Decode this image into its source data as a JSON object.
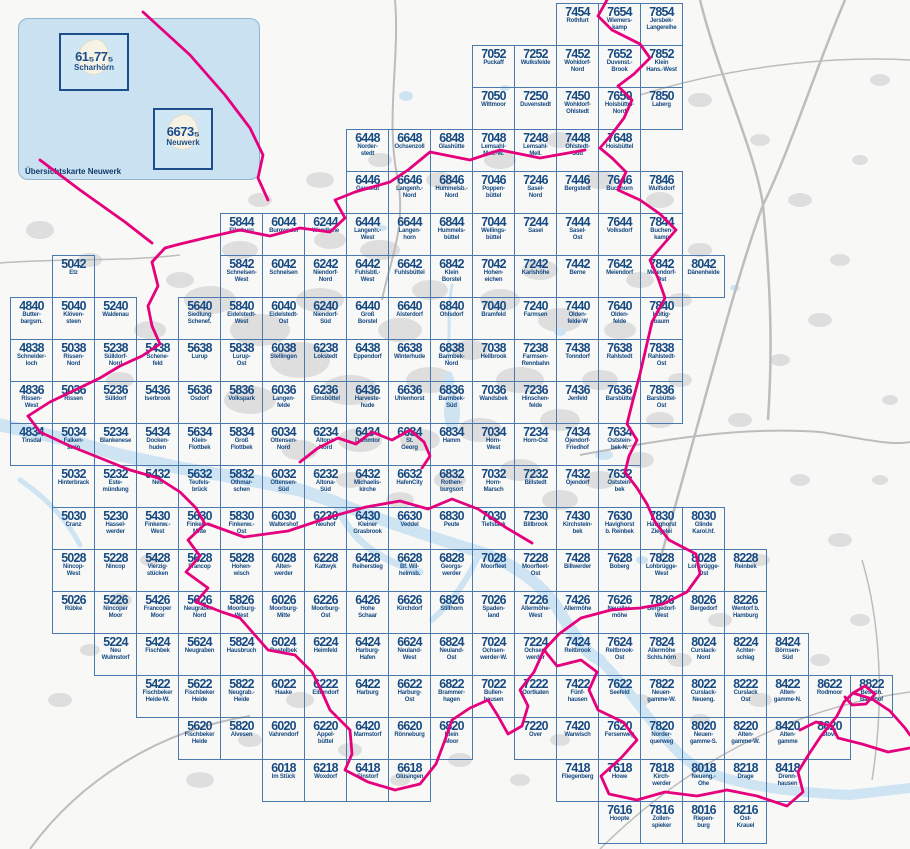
{
  "colors": {
    "accent_magenta": "#e5007d",
    "grid_blue": "#4a79ad",
    "label_blue": "#174a82",
    "water_blue": "#cfe4f2",
    "inset_blue": "#c9e1f1",
    "land_gray": "#dedede"
  },
  "inset": {
    "caption": "Übersichtskarte Neuwerk",
    "islands": [
      {
        "number": "61₅77₅",
        "name": "Scharhörn"
      },
      {
        "number": "6673₅",
        "name": "Neuwerk"
      }
    ]
  },
  "tiles": [
    {
      "id": "7454",
      "name": "Rothfurt"
    },
    {
      "id": "7654",
      "name": "Wiemers-\nkamp"
    },
    {
      "id": "7854",
      "name": "Jersbek-\nLangereihe"
    },
    {
      "id": "7052",
      "name": "Puckaff"
    },
    {
      "id": "7252",
      "name": "Wulksfelde"
    },
    {
      "id": "7452",
      "name": "Wohldorf-\nNord"
    },
    {
      "id": "7652",
      "name": "Duvenst.-\nBrook"
    },
    {
      "id": "7852",
      "name": "Klein\nHans.-West"
    },
    {
      "id": "7050",
      "name": "Wittmoor"
    },
    {
      "id": "7250",
      "name": "Duvenstedt"
    },
    {
      "id": "7450",
      "name": "Wohldorf-\nOhlstedt"
    },
    {
      "id": "7650",
      "name": "Hoisbüttel-\nNord"
    },
    {
      "id": "7850",
      "name": "Laberg"
    },
    {
      "id": "6448",
      "name": "Norder-\nstedt"
    },
    {
      "id": "6648",
      "name": "Ochsenzoll"
    },
    {
      "id": "6848",
      "name": "Glashütte"
    },
    {
      "id": "7048",
      "name": "Lemsahl-\nMell.-W."
    },
    {
      "id": "7248",
      "name": "Lemsahl-\nMell."
    },
    {
      "id": "7448",
      "name": "Ohlstedt-\nSüd"
    },
    {
      "id": "7648",
      "name": "Hoisbüttel"
    },
    {
      "id": "6446",
      "name": "Garstedt"
    },
    {
      "id": "6646",
      "name": "Langenh.-\nNord"
    },
    {
      "id": "6846",
      "name": "Hummelsb.-\nNord"
    },
    {
      "id": "7046",
      "name": "Poppen-\nbüttel"
    },
    {
      "id": "7246",
      "name": "Sasel-\nNord"
    },
    {
      "id": "7446",
      "name": "Bergstedt"
    },
    {
      "id": "7646",
      "name": "Buckhorn"
    },
    {
      "id": "7846",
      "name": "Wulfsdorf"
    },
    {
      "id": "5844",
      "name": "Ellerburg"
    },
    {
      "id": "6044",
      "name": "Burgwedel"
    },
    {
      "id": "6244",
      "name": "Wendlohe"
    },
    {
      "id": "6444",
      "name": "Langenh.-\nWest"
    },
    {
      "id": "6644",
      "name": "Langen-\nhorn"
    },
    {
      "id": "6844",
      "name": "Hummels-\nbüttel"
    },
    {
      "id": "7044",
      "name": "Wellings-\nbüttel"
    },
    {
      "id": "7244",
      "name": "Sasel"
    },
    {
      "id": "7444",
      "name": "Sasel-\nOst"
    },
    {
      "id": "7644",
      "name": "Volksdorf"
    },
    {
      "id": "7844",
      "name": "Buchen-\nkamp"
    },
    {
      "id": "5042",
      "name": "Etz"
    },
    {
      "id": "5842",
      "name": "Schnelsen-\nWest"
    },
    {
      "id": "6042",
      "name": "Schnelsen"
    },
    {
      "id": "6242",
      "name": "Niendorf-\nNord"
    },
    {
      "id": "6442",
      "name": "Fuhlsbtl.-\nWest"
    },
    {
      "id": "6642",
      "name": "Fuhlsbüttel"
    },
    {
      "id": "6842",
      "name": "Klein\nBorstel"
    },
    {
      "id": "7042",
      "name": "Hohen-\neichen"
    },
    {
      "id": "7242",
      "name": "Karlshöhe"
    },
    {
      "id": "7442",
      "name": "Berne"
    },
    {
      "id": "7642",
      "name": "Meiendorf"
    },
    {
      "id": "7842",
      "name": "Meiendorf-\nOst"
    },
    {
      "id": "8042",
      "name": "Dänenheide"
    },
    {
      "id": "4840",
      "name": "Butter-\nbargsm."
    },
    {
      "id": "5040",
      "name": "Klöven-\nsteen"
    },
    {
      "id": "5240",
      "name": "Waldenau"
    },
    {
      "id": "5640",
      "name": "Siedlung\nSchenef."
    },
    {
      "id": "5840",
      "name": "Eidelstedt-\nWest"
    },
    {
      "id": "6040",
      "name": "Eidelstedt-\nOst"
    },
    {
      "id": "6240",
      "name": "Niendorf-\nSüd"
    },
    {
      "id": "6440",
      "name": "Groß\nBorstel"
    },
    {
      "id": "6640",
      "name": "Alsterdorf"
    },
    {
      "id": "6840",
      "name": "Ohlsdorf"
    },
    {
      "id": "7040",
      "name": "Bramfeld"
    },
    {
      "id": "7240",
      "name": "Farmsen"
    },
    {
      "id": "7440",
      "name": "Olden-\nfelde-W"
    },
    {
      "id": "7640",
      "name": "Olden-\nfelde"
    },
    {
      "id": "7840",
      "name": "Höltig-\nbaum"
    },
    {
      "id": "4838",
      "name": "Schneider-\nloch"
    },
    {
      "id": "5038",
      "name": "Rissen-\nNord"
    },
    {
      "id": "5238",
      "name": "Sülldorf-\nNord"
    },
    {
      "id": "5438",
      "name": "Schene-\nfeld"
    },
    {
      "id": "5638",
      "name": "Lurup"
    },
    {
      "id": "5838",
      "name": "Lurup-\nOst"
    },
    {
      "id": "6038",
      "name": "Stellingen"
    },
    {
      "id": "6238",
      "name": "Lokstedt"
    },
    {
      "id": "6438",
      "name": "Eppendorf"
    },
    {
      "id": "6638",
      "name": "Winterhude"
    },
    {
      "id": "6838",
      "name": "Barmbek-\nNord"
    },
    {
      "id": "7038",
      "name": "Hellbrook"
    },
    {
      "id": "7238",
      "name": "Farmsen-\nRennbahn"
    },
    {
      "id": "7438",
      "name": "Tonndorf"
    },
    {
      "id": "7638",
      "name": "Rahlstedt"
    },
    {
      "id": "7838",
      "name": "Rahlstedt-\nOst"
    },
    {
      "id": "4836",
      "name": "Rissen-\nWest"
    },
    {
      "id": "5036",
      "name": "Rissen"
    },
    {
      "id": "5236",
      "name": "Sülldorf"
    },
    {
      "id": "5436",
      "name": "Iserbrook"
    },
    {
      "id": "5636",
      "name": "Osdorf"
    },
    {
      "id": "5836",
      "name": "Volkspark"
    },
    {
      "id": "6036",
      "name": "Langen-\nfelde"
    },
    {
      "id": "6236",
      "name": "Eimsbüttel"
    },
    {
      "id": "6436",
      "name": "Harveste-\nhude"
    },
    {
      "id": "6636",
      "name": "Uhlenhorst"
    },
    {
      "id": "6836",
      "name": "Barmbek-\nSüd"
    },
    {
      "id": "7036",
      "name": "Wandsbek"
    },
    {
      "id": "7236",
      "name": "Hinschen-\nfelde"
    },
    {
      "id": "7436",
      "name": "Jenfeld"
    },
    {
      "id": "7636",
      "name": "Barsbüttel"
    },
    {
      "id": "7836",
      "name": "Barsbüttel-\nOst"
    },
    {
      "id": "4834",
      "name": "Tinsdal"
    },
    {
      "id": "5034",
      "name": "Falken-\nstein"
    },
    {
      "id": "5234",
      "name": "Blankenese"
    },
    {
      "id": "5434",
      "name": "Docken-\nhuden"
    },
    {
      "id": "5634",
      "name": "Klein-\nFlottbek"
    },
    {
      "id": "5834",
      "name": "Groß\nFlottbek"
    },
    {
      "id": "6034",
      "name": "Ottensen-\nNord"
    },
    {
      "id": "6234",
      "name": "Altona-\nNord"
    },
    {
      "id": "6434",
      "name": "Dammtor"
    },
    {
      "id": "6634",
      "name": "St.\nGeorg"
    },
    {
      "id": "6834",
      "name": "Hamm"
    },
    {
      "id": "7034",
      "name": "Horn-\nWest"
    },
    {
      "id": "7234",
      "name": "Horn-Ost"
    },
    {
      "id": "7434",
      "name": "Öjendorf-\nFriedhof"
    },
    {
      "id": "7634",
      "name": "Oststein-\nbek-N."
    },
    {
      "id": "5032",
      "name": "Hinterbrack"
    },
    {
      "id": "5232",
      "name": "Este-\nmündung"
    },
    {
      "id": "5432",
      "name": "Neß"
    },
    {
      "id": "5632",
      "name": "Teufels-\nbrück"
    },
    {
      "id": "5832",
      "name": "Othmar-\nschen"
    },
    {
      "id": "6032",
      "name": "Ottensen-\nSüd"
    },
    {
      "id": "6232",
      "name": "Altona-\nSüd"
    },
    {
      "id": "6432",
      "name": "Michaelis-\nkirche"
    },
    {
      "id": "6632",
      "name": "HafenCity"
    },
    {
      "id": "6832",
      "name": "Rothen-\nburgsort"
    },
    {
      "id": "7032",
      "name": "Horn-\nMarsch"
    },
    {
      "id": "7232",
      "name": "Billstedt"
    },
    {
      "id": "7432",
      "name": "Öjendorf"
    },
    {
      "id": "7632",
      "name": "Oststein-\nbek"
    },
    {
      "id": "5030",
      "name": "Cranz"
    },
    {
      "id": "5230",
      "name": "Hassel-\nwerder"
    },
    {
      "id": "5430",
      "name": "Finkenw.-\nWest"
    },
    {
      "id": "5630",
      "name": "Finkenw.-\nMitte"
    },
    {
      "id": "5830",
      "name": "Finkenw.-\nOst"
    },
    {
      "id": "6030",
      "name": "Waltershof"
    },
    {
      "id": "6230",
      "name": "Neuhof"
    },
    {
      "id": "6430",
      "name": "Kleiner\nGrasbrook"
    },
    {
      "id": "6630",
      "name": "Veddel"
    },
    {
      "id": "6830",
      "name": "Peute"
    },
    {
      "id": "7030",
      "name": "Tiefstack"
    },
    {
      "id": "7230",
      "name": "Billbrook"
    },
    {
      "id": "7430",
      "name": "Kirchstein-\nbek"
    },
    {
      "id": "7630",
      "name": "Havighorst\nb. Reinbek"
    },
    {
      "id": "7830",
      "name": "Havighorst\nZiegelei"
    },
    {
      "id": "8030",
      "name": "Glinde\nKarol.hf."
    },
    {
      "id": "5028",
      "name": "Nincop-\nWest"
    },
    {
      "id": "5228",
      "name": "Nincop"
    },
    {
      "id": "5428",
      "name": "Vierzig-\nstücken"
    },
    {
      "id": "5628",
      "name": "Francop"
    },
    {
      "id": "5828",
      "name": "Hohen-\nwisch"
    },
    {
      "id": "6028",
      "name": "Alten-\nwerder"
    },
    {
      "id": "6228",
      "name": "Kattwyk"
    },
    {
      "id": "6428",
      "name": "Reiherstieg"
    },
    {
      "id": "6628",
      "name": "Bf. Wil-\nhelmsb."
    },
    {
      "id": "6828",
      "name": "Georgs-\nwerder"
    },
    {
      "id": "7028",
      "name": "Moorfleet"
    },
    {
      "id": "7228",
      "name": "Moorfleet-\nOst"
    },
    {
      "id": "7428",
      "name": "Billwerder"
    },
    {
      "id": "7628",
      "name": "Boberg"
    },
    {
      "id": "7828",
      "name": "Lohbrügge-\nWest"
    },
    {
      "id": "8028",
      "name": "Lohbrügge-\nOst"
    },
    {
      "id": "8228",
      "name": "Reinbek"
    },
    {
      "id": "5026",
      "name": "Rübke"
    },
    {
      "id": "5226",
      "name": "Nincoper\nMoor"
    },
    {
      "id": "5426",
      "name": "Francoper\nMoor"
    },
    {
      "id": "5626",
      "name": "Neugraben-\nNord"
    },
    {
      "id": "5826",
      "name": "Moorburg-\nWest"
    },
    {
      "id": "6026",
      "name": "Moorburg-\nMitte"
    },
    {
      "id": "6226",
      "name": "Moorburg-\nOst"
    },
    {
      "id": "6426",
      "name": "Hohe\nSchaar"
    },
    {
      "id": "6626",
      "name": "Kirchdorf"
    },
    {
      "id": "6826",
      "name": "Stillhorn"
    },
    {
      "id": "7026",
      "name": "Spaden-\nland"
    },
    {
      "id": "7226",
      "name": "Allermöhe-\nWest"
    },
    {
      "id": "7426",
      "name": "Allermöhe"
    },
    {
      "id": "7626",
      "name": "Neualler-\nmöhe"
    },
    {
      "id": "7826",
      "name": "Bergedorf-\nWest"
    },
    {
      "id": "8026",
      "name": "Bergedorf"
    },
    {
      "id": "8226",
      "name": "Wentorf b.\nHamburg"
    },
    {
      "id": "5224",
      "name": "Neu\nWulmstorf"
    },
    {
      "id": "5424",
      "name": "Fischbek"
    },
    {
      "id": "5624",
      "name": "Neugraben"
    },
    {
      "id": "5824",
      "name": "Hausbruch"
    },
    {
      "id": "6024",
      "name": "Bostelbek"
    },
    {
      "id": "6224",
      "name": "Heimfeld"
    },
    {
      "id": "6424",
      "name": "Harburg-\nHafen"
    },
    {
      "id": "6624",
      "name": "Neuland-\nWest"
    },
    {
      "id": "6824",
      "name": "Neuland-\nOst"
    },
    {
      "id": "7024",
      "name": "Ochsen-\nwerder-W."
    },
    {
      "id": "7224",
      "name": "Ochsen-\nwerder"
    },
    {
      "id": "7424",
      "name": "Reitbrook"
    },
    {
      "id": "7624",
      "name": "Reitbrook-\nOst"
    },
    {
      "id": "7824",
      "name": "Allermöhe\nSchls.hörn"
    },
    {
      "id": "8024",
      "name": "Curslack-\nNord"
    },
    {
      "id": "8224",
      "name": "Achter-\nschlag"
    },
    {
      "id": "8424",
      "name": "Börnsen-\nSüd"
    },
    {
      "id": "5422",
      "name": "Fischbeker\nHeide-W."
    },
    {
      "id": "5622",
      "name": "Fischbeker\nHeide"
    },
    {
      "id": "5822",
      "name": "Neugrab.-\nHeide"
    },
    {
      "id": "6022",
      "name": "Haake"
    },
    {
      "id": "6222",
      "name": "Eißendorf"
    },
    {
      "id": "6422",
      "name": "Harburg"
    },
    {
      "id": "6622",
      "name": "Harburg-\nOst"
    },
    {
      "id": "6822",
      "name": "Brammer-\nhagen"
    },
    {
      "id": "7022",
      "name": "Bullen-\nhausen"
    },
    {
      "id": "7222",
      "name": "Oortkaten"
    },
    {
      "id": "7422",
      "name": "Fünf-\nhausen"
    },
    {
      "id": "7622",
      "name": "Seefeld"
    },
    {
      "id": "7822",
      "name": "Neuen-\ngamme-W."
    },
    {
      "id": "8022",
      "name": "Curslack-\nNeueng."
    },
    {
      "id": "8222",
      "name": "Curslack\nOst"
    },
    {
      "id": "8422",
      "name": "Alten-\ngamme-N."
    },
    {
      "id": "8622",
      "name": "Rodmoor"
    },
    {
      "id": "8822",
      "name": "Besenh.\nBahnhof"
    },
    {
      "id": "5620",
      "name": "Fischbeker\nHeide"
    },
    {
      "id": "5820",
      "name": "Alvesen"
    },
    {
      "id": "6020",
      "name": "Vahrendorf"
    },
    {
      "id": "6220",
      "name": "Appel-\nbüttel"
    },
    {
      "id": "6420",
      "name": "Marmstorf"
    },
    {
      "id": "6620",
      "name": "Rönneburg"
    },
    {
      "id": "6820",
      "name": "Klein\nMoor"
    },
    {
      "id": "7220",
      "name": "Over"
    },
    {
      "id": "7420",
      "name": "Warwisch"
    },
    {
      "id": "7620",
      "name": "Fersenweg"
    },
    {
      "id": "7820",
      "name": "Norder-\nquerweg"
    },
    {
      "id": "8020",
      "name": "Neuen-\ngamme-S."
    },
    {
      "id": "8220",
      "name": "Alten-\ngamme-W."
    },
    {
      "id": "8420",
      "name": "Alten-\ngamme"
    },
    {
      "id": "8620",
      "name": "Stove"
    },
    {
      "id": "6018",
      "name": "Im Stück"
    },
    {
      "id": "6218",
      "name": "Woxdorf"
    },
    {
      "id": "6418",
      "name": "Sinstorf"
    },
    {
      "id": "6618",
      "name": "Glüsingen"
    },
    {
      "id": "7418",
      "name": "Fliegenberg"
    },
    {
      "id": "7618",
      "name": "Howe"
    },
    {
      "id": "7818",
      "name": "Kirch-\nwerder"
    },
    {
      "id": "8018",
      "name": "Neueng.-\nOhe"
    },
    {
      "id": "8218",
      "name": "Drage"
    },
    {
      "id": "8418",
      "name": "Drenn-\nhausen"
    },
    {
      "id": "7616",
      "name": "Hoopte"
    },
    {
      "id": "7816",
      "name": "Zollen-\nspieker"
    },
    {
      "id": "8016",
      "name": "Riepen-\nburg"
    },
    {
      "id": "8216",
      "name": "Ost-\nKrauel"
    }
  ]
}
